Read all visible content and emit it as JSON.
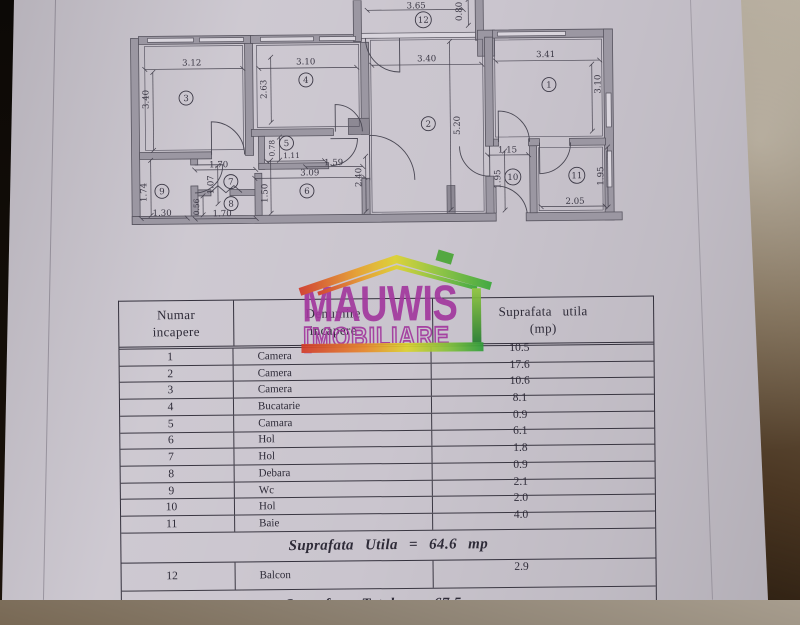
{
  "floorplan": {
    "rooms": [
      {
        "n": "1",
        "x": 551,
        "y": 86
      },
      {
        "n": "2",
        "x": 430,
        "y": 124
      },
      {
        "n": "3",
        "x": 188,
        "y": 96
      },
      {
        "n": "4",
        "x": 308,
        "y": 79
      },
      {
        "n": "5",
        "x": 288,
        "y": 142
      },
      {
        "n": "6",
        "x": 308,
        "y": 190
      },
      {
        "n": "7",
        "x": 232,
        "y": 180
      },
      {
        "n": "8",
        "x": 232,
        "y": 202
      },
      {
        "n": "9",
        "x": 163,
        "y": 189
      },
      {
        "n": "10",
        "x": 514,
        "y": 178
      },
      {
        "n": "11",
        "x": 578,
        "y": 177
      },
      {
        "n": "12",
        "x": 426,
        "y": 20
      }
    ],
    "dims": [
      {
        "t": "3.65",
        "x": 419,
        "y": 6,
        "r": 0,
        "l": [
          370,
          10,
          466,
          10
        ]
      },
      {
        "t": "0.80",
        "x": 462,
        "y": 12,
        "r": -90,
        "l": [
          471,
          0,
          471,
          26
        ]
      },
      {
        "t": "3.12",
        "x": 194,
        "y": 61,
        "r": 0,
        "l": [
          147,
          67,
          245,
          67
        ]
      },
      {
        "t": "3.40",
        "x": 148,
        "y": 97,
        "r": -90,
        "l": [
          155,
          70,
          155,
          148
        ]
      },
      {
        "t": "3.10",
        "x": 308,
        "y": 61,
        "r": 0,
        "l": [
          261,
          67,
          359,
          67
        ]
      },
      {
        "t": "2.63",
        "x": 266,
        "y": 88,
        "r": -90,
        "l": [
          273,
          56,
          273,
          121
        ]
      },
      {
        "t": "3.40",
        "x": 429,
        "y": 59,
        "r": 0,
        "l": [
          374,
          65,
          484,
          65
        ]
      },
      {
        "t": "3.41",
        "x": 548,
        "y": 56,
        "r": 0,
        "l": [
          498,
          62,
          602,
          62
        ]
      },
      {
        "t": "3.10",
        "x": 600,
        "y": 86,
        "r": -90,
        "l": [
          594,
          66,
          594,
          133
        ]
      },
      {
        "t": "5.20",
        "x": 459,
        "y": 126,
        "r": -90,
        "l": [
          452,
          42,
          452,
          210
        ]
      },
      {
        "t": "0.78",
        "x": 274,
        "y": 147,
        "r": -90,
        "s": 7.5,
        "l": [
          281,
          136,
          281,
          159
        ]
      },
      {
        "t": "1.11",
        "x": 293,
        "y": 155,
        "r": 0,
        "s": 7.5,
        "l": [
          268,
          160,
          326,
          160
        ]
      },
      {
        "t": "1.59",
        "x": 335,
        "y": 162,
        "r": 0,
        "l": [
          307,
          166,
          364,
          166
        ]
      },
      {
        "t": "3.09",
        "x": 311,
        "y": 172,
        "r": 0,
        "l": [
          256,
          177,
          366,
          177
        ]
      },
      {
        "t": "2.40",
        "x": 360,
        "y": 177,
        "r": -90,
        "l": [
          367,
          156,
          367,
          211
        ]
      },
      {
        "t": "1.70",
        "x": 220,
        "y": 163,
        "r": 0,
        "l": [
          196,
          168,
          257,
          168
        ]
      },
      {
        "t": "1.07",
        "x": 212,
        "y": 183,
        "r": -90,
        "l": [
          219,
          164,
          219,
          202
        ]
      },
      {
        "t": "1.50",
        "x": 266,
        "y": 192,
        "r": -90,
        "l": [
          272,
          159,
          272,
          212
        ]
      },
      {
        "t": "1.74",
        "x": 145,
        "y": 190,
        "r": -90,
        "l": [
          152,
          158,
          152,
          213
        ]
      },
      {
        "t": "1.30",
        "x": 163,
        "y": 211,
        "r": 0,
        "l": [
          142,
          216,
          188,
          216
        ]
      },
      {
        "t": "0.56",
        "x": 198,
        "y": 205,
        "r": -90,
        "s": 7.5,
        "l": [
          204,
          194,
          204,
          213
        ]
      },
      {
        "t": "1.70",
        "x": 223,
        "y": 212,
        "r": 0,
        "l": [
          196,
          217,
          257,
          217
        ]
      },
      {
        "t": "1.15",
        "x": 509,
        "y": 151,
        "r": 0,
        "l": [
          489,
          156,
          530,
          156
        ]
      },
      {
        "t": "1.95",
        "x": 499,
        "y": 180,
        "r": -90,
        "l": [
          506,
          152,
          506,
          211
        ]
      },
      {
        "t": "2.05",
        "x": 576,
        "y": 203,
        "r": 0,
        "l": [
          542,
          208,
          606,
          208
        ]
      },
      {
        "t": "1.95",
        "x": 602,
        "y": 178,
        "r": -90,
        "l": [
          609,
          149,
          609,
          209
        ]
      }
    ]
  },
  "table": {
    "headers": [
      {
        "line1": "Numar",
        "line2": "incapere"
      },
      {
        "line1": "Denumire",
        "line2": "incapere"
      },
      {
        "line1": "Suprafata utila",
        "line2": "(mp)"
      }
    ],
    "rows": [
      {
        "nr": "1",
        "name": "Camera",
        "area": "10.5"
      },
      {
        "nr": "2",
        "name": "Camera",
        "area": "17.6"
      },
      {
        "nr": "3",
        "name": "Camera",
        "area": "10.6"
      },
      {
        "nr": "4",
        "name": "Bucatarie",
        "area": "8.1"
      },
      {
        "nr": "5",
        "name": "Camara",
        "area": "0.9"
      },
      {
        "nr": "6",
        "name": "Hol",
        "area": "6.1"
      },
      {
        "nr": "7",
        "name": "Hol",
        "area": "1.8"
      },
      {
        "nr": "8",
        "name": "Debara",
        "area": "0.9"
      },
      {
        "nr": "9",
        "name": "Wc",
        "area": "2.1"
      },
      {
        "nr": "10",
        "name": "Hol",
        "area": "2.0"
      },
      {
        "nr": "11",
        "name": "Baie",
        "area": "4.0"
      }
    ],
    "summary_utila": "Suprafata Utila = 64.6 mp",
    "row12": {
      "nr": "12",
      "name": "Balcon",
      "area": "2.9"
    },
    "summary_totala": "Suprafata Totala = 67.5 mp"
  },
  "watermark": {
    "brand": "MAUWIS",
    "sub": "[MOBILIARE",
    "brand_color": "#a2389e",
    "roof_gradient": [
      "#d23b2a",
      "#e8a02c",
      "#ded32f",
      "#8fc63c",
      "#3aa838"
    ],
    "wall_bar_gradient": [
      "#8fc63c",
      "#1f7a2e"
    ]
  },
  "colors": {
    "paper": "#cac5ce",
    "ink": "#3a3744",
    "wall_fill": "#9b97a2",
    "wood_dark": "#2b1d10"
  }
}
